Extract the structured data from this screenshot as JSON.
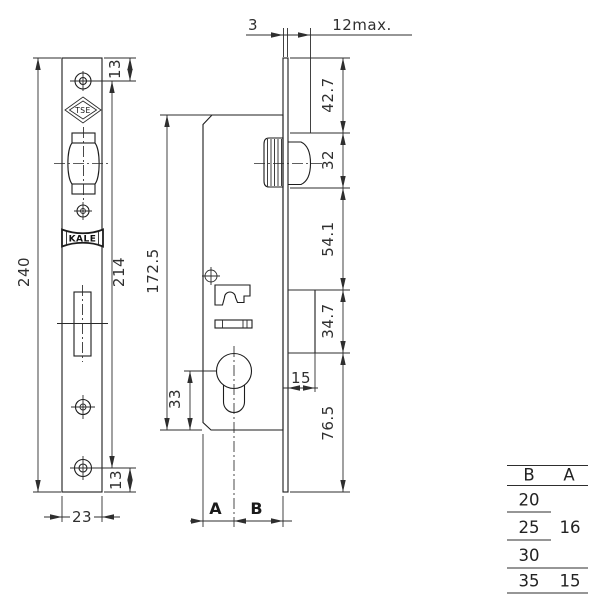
{
  "labels": {
    "plate_height": "240",
    "screw_span": "214",
    "offset_top": "13",
    "offset_bottom": "13",
    "plate_width": "23",
    "case_height": "172.5",
    "cyl_to_bottom": "33",
    "backset_a": "A",
    "backset_b": "B",
    "plate_thickness": "3",
    "latch_projection": "12max.",
    "seg_top": "42.7",
    "seg_roller": "32",
    "seg_mid": "54.1",
    "seg_bolt": "34.7",
    "seg_bottom": "76.5",
    "bolt_throw": "15",
    "logo_tse": "TSE",
    "logo_kale": "KALE"
  },
  "table": {
    "header_b": "B",
    "header_a": "A",
    "rows_b": [
      "20",
      "25",
      "30",
      "35"
    ],
    "a_shared": "16",
    "a_last": "15"
  }
}
